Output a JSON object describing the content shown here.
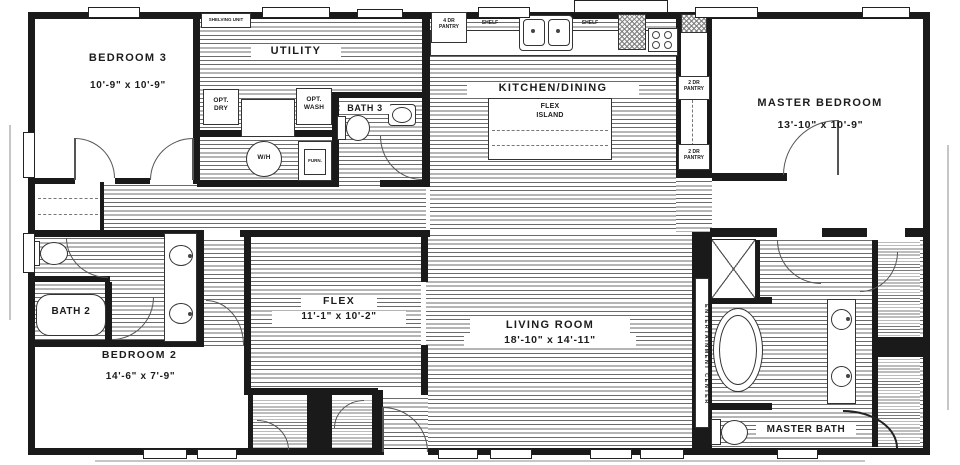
{
  "labels": {
    "bedroom3_name": "BEDROOM 3",
    "bedroom3_dims": "10'-9\" x  10'-9\"",
    "utility": "UTILITY",
    "shelving_unit": "SHELVING UNIT",
    "opt_dry": "OPT.\nDRY",
    "opt_wash": "OPT.\nWASH",
    "water_heater": "W/H",
    "furnace": "FURN.",
    "bath3": "BATH 3",
    "pantry_4dr": "4 DR\nPANTRY",
    "shelf_left": "SHELF",
    "shelf_right": "SHELF",
    "kitchen": "KITCHEN/DINING",
    "flex_island": "FLEX\nISLAND",
    "pantry_2dr_upper": "2 DR\nPANTRY",
    "pantry_2dr_lower": "2 DR\nPANTRY",
    "master_bedroom_name": "MASTER BEDROOM",
    "master_bedroom_dims": "13'-10\" x  10'-9\"",
    "bath2": "BATH 2",
    "bedroom2_name": "BEDROOM 2",
    "bedroom2_dims": "14'-6\" x  7'-9\"",
    "flex_name": "FLEX",
    "flex_dims": "11'-1\" x  10'-2\"",
    "living_name": "LIVING ROOM",
    "living_dims": "18'-10\" x  14'-11\"",
    "entertainment_center": "ENTERTAINMENT CENTER",
    "master_bath": "MASTER BATH"
  }
}
